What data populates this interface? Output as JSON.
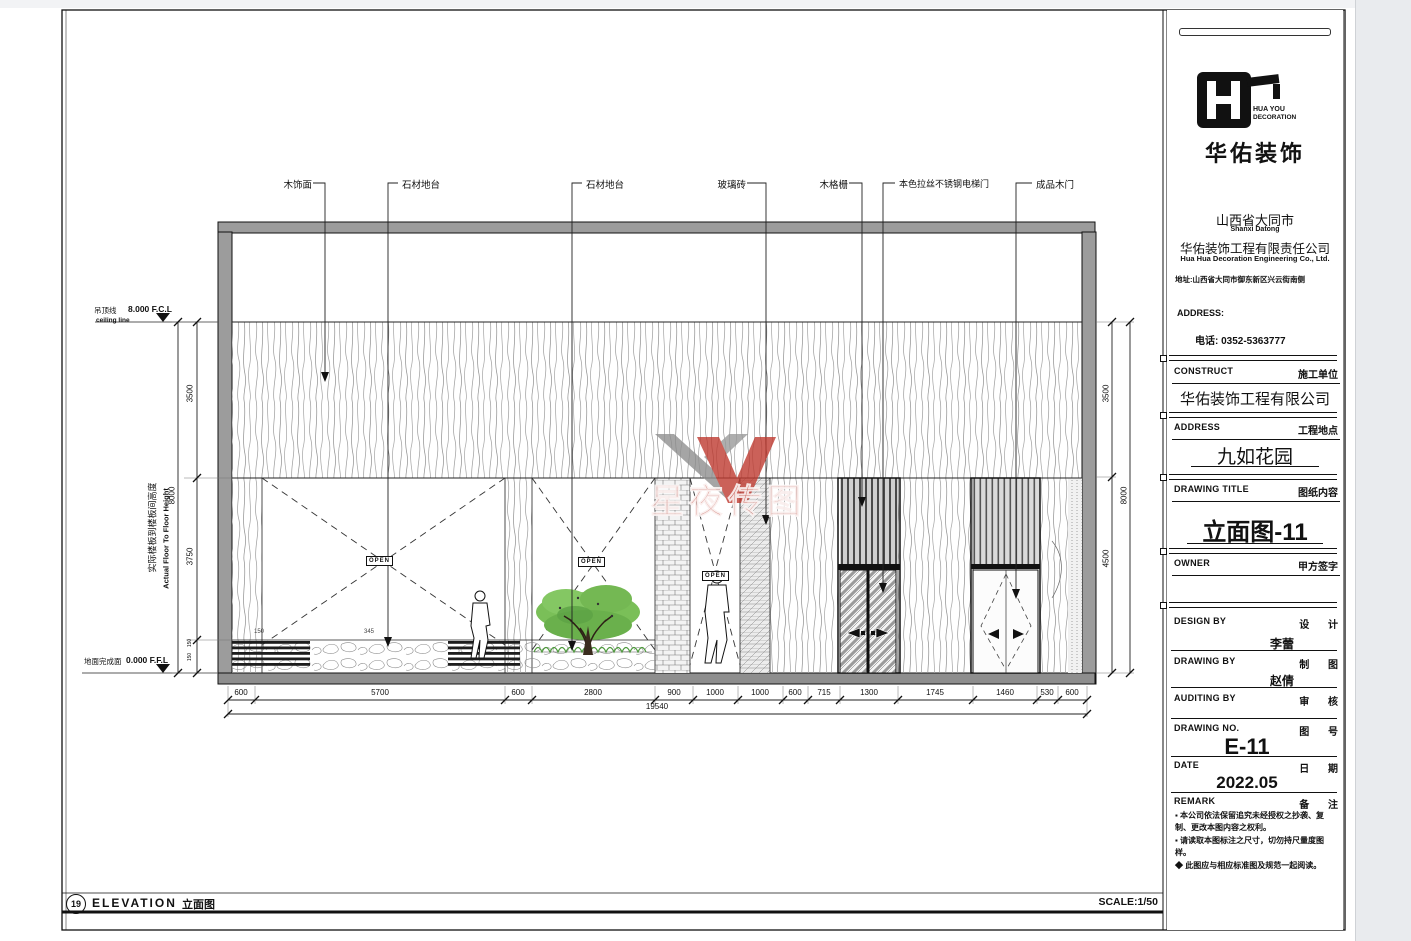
{
  "sheet": {
    "footer": {
      "number": "19",
      "title_en": "ELEVATION",
      "title_cn": "立面图",
      "scale": "SCALE:1/50"
    },
    "watermark": {
      "text": "星夜传图"
    }
  },
  "drawing": {
    "open_label": "OPEN",
    "callouts": [
      "木饰面",
      "石材地台",
      "石材地台",
      "玻璃砖",
      "木格栅",
      "本色拉丝不锈钢电梯门",
      "成品木门"
    ],
    "levels": {
      "ceiling_label": "吊顶线",
      "ceiling_value": "8.000 F.C.L",
      "ceiling_sub": "ceiling line",
      "floor_label": "地面完成面",
      "floor_value": "0.000 F.F.L"
    },
    "axis": {
      "cn": "实际楼板到楼板间高度",
      "en": "Actual Floor To Floor Height"
    },
    "dims": {
      "bottom": [
        "600",
        "5700",
        "600",
        "2800",
        "900",
        "1000",
        "1000",
        "600",
        "715",
        "1300",
        "1745",
        "1460",
        "530",
        "600"
      ],
      "bottom_overall": "19540",
      "left": [
        "3500",
        "3750"
      ],
      "left_steps": [
        "150",
        "150"
      ],
      "left_overall": "8000",
      "right": [
        "3500",
        "4500"
      ],
      "right_overall": "8000",
      "platform": [
        "150",
        "345"
      ]
    }
  },
  "title_block": {
    "brand": {
      "en1": "HUA YOU",
      "en2": "DECORATION",
      "cn": "华佑装饰"
    },
    "firm": {
      "city_cn": "山西省大同市",
      "city_en": "Shanxi Datong",
      "name_cn": "华佑装饰工程有限责任公司",
      "name_en": "Hua Hua Decoration Engineering Co., Ltd.",
      "address": "地址:山西省大同市御东新区兴云街南侧",
      "address_label": "ADDRESS:",
      "phone": "电话: 0352-5363777"
    },
    "construct": {
      "en": "CONSTRUCT",
      "cn": "施工单位",
      "value": "华佑装饰工程有限公司"
    },
    "site": {
      "en": "ADDRESS",
      "cn": "工程地点",
      "value": "九如花园"
    },
    "drawing_title": {
      "en": "DRAWING TITLE",
      "cn": "图纸内容",
      "value": "立面图-11"
    },
    "owner": {
      "en": "OWNER",
      "cn": "甲方签字"
    },
    "design": {
      "en": "DESIGN BY",
      "cn": "设 计",
      "value": "李蕾"
    },
    "draft": {
      "en": "DRAWING BY",
      "cn": "制 图",
      "value": "赵倩"
    },
    "audit": {
      "en": "AUDITING BY",
      "cn": "审 核",
      "value": ""
    },
    "number": {
      "en": "DRAWING NO.",
      "cn": "图 号",
      "value": "E-11"
    },
    "date": {
      "en": "DATE",
      "cn": "日 期",
      "value": "2022.05"
    },
    "remark": {
      "en": "REMARK",
      "cn": "备 注"
    },
    "notes": [
      "▪ 本公司依法保留追究未经授权之抄袭、复制、更改本图内容之权利。",
      "▪ 请读取本图标注之尺寸，切勿持尺量度图样。",
      "◆ 此图应与相应标准图及规范一起阅读。"
    ]
  }
}
